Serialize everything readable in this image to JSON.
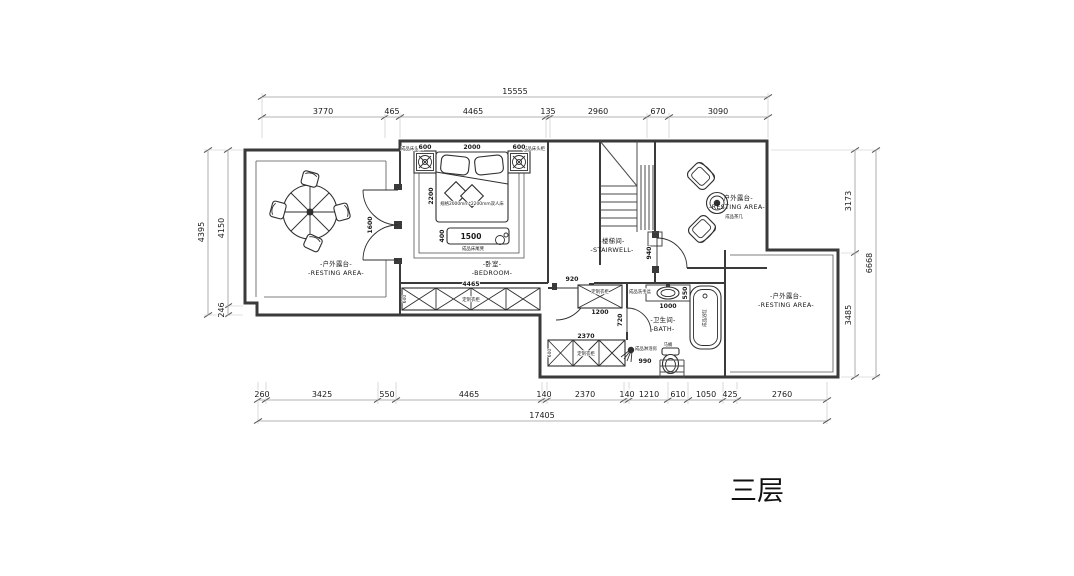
{
  "title": "三层",
  "dims": {
    "top": {
      "overall": "15555",
      "segments": [
        "3770",
        "465",
        "4465",
        "135",
        "2960",
        "670",
        "3090"
      ]
    },
    "bottom": {
      "overall": "17405",
      "segments": [
        "260",
        "3425",
        "550",
        "4465",
        "140",
        "2370",
        "140",
        "1210",
        "610",
        "1050",
        "425",
        "2760"
      ]
    },
    "left": {
      "overall": "4395",
      "segments": [
        "4150",
        "246"
      ]
    },
    "right": {
      "overall": "6668",
      "segments": [
        "3173",
        "3485"
      ]
    }
  },
  "rooms": {
    "balcony_left": {
      "cn": "-户外露台-",
      "en": "-RESTING AREA-"
    },
    "bedroom": {
      "cn": "-卧室-",
      "en": "-BEDROOM-"
    },
    "stairwell": {
      "cn": "-楼梯间-",
      "en": "-STAIRWELL-"
    },
    "balcony_top_right": {
      "cn": "-户外露台-",
      "en": "-RESTING AREA-"
    },
    "bath": {
      "cn": "-卫生间-",
      "en": "-BATH-"
    },
    "balcony_right": {
      "cn": "-户外露台-",
      "en": "-RESTING AREA-"
    }
  },
  "furniture": {
    "bed_spec": "规格2000mm*2200mm双人床",
    "bench": "成品床尾凳",
    "nightstand": "成品床头柜",
    "wardrobe": "定制衣柜",
    "tea_table": "成品茶几",
    "bathtub": "成品浴缸",
    "toilet": "马桶",
    "shower": "成品淋浴房",
    "sink": "成品洗手盆"
  },
  "inline_dims": {
    "nightstand_left": "600",
    "bed_width": "2000",
    "nightstand_right": "600",
    "bed_length": "2200",
    "bench_length": "1500",
    "bench_depth": "400",
    "french_door": "1600",
    "wardrobe_long": "4465",
    "wardrobe_long_depth": "600",
    "door_corridor": "920",
    "door_stair": "940",
    "door_bath": "720",
    "wardrobe_small": "1200",
    "sink_width": "1000",
    "sink_depth": "550",
    "wardrobe_bath": "2370",
    "wardrobe_bath_depth": "600",
    "shower_width": "990"
  },
  "colors": {
    "wall": "#3a3a3a",
    "dim_line": "#9a9a9a",
    "text": "#1a1a1a",
    "background": "#ffffff"
  }
}
